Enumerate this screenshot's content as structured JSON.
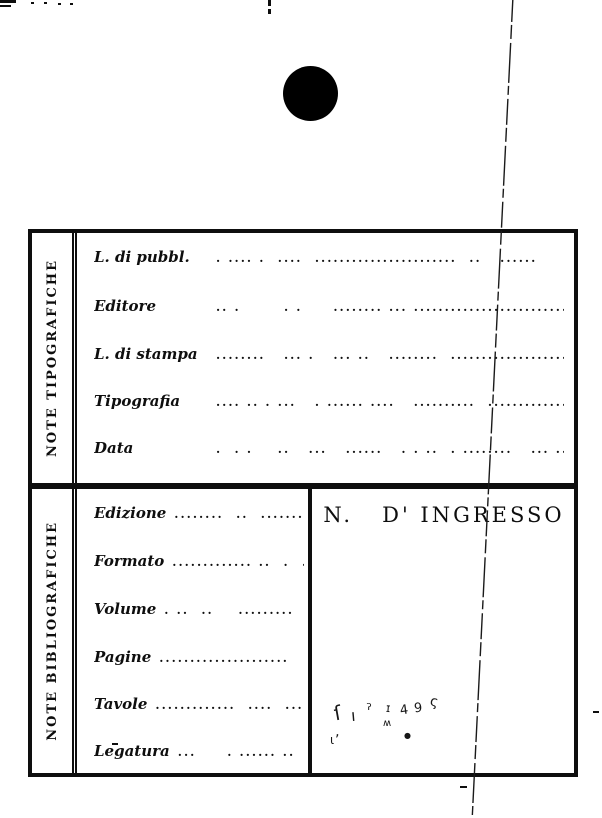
{
  "page": {
    "background": "#ffffff",
    "ink": "#0e0e0e"
  },
  "artifacts": {
    "punch_hole": {
      "x": 283,
      "y": 66,
      "diameter": 55
    },
    "diagonal_line": {
      "x1": 513,
      "y1": -4,
      "x2": 472,
      "y2": 822
    },
    "noise_rects": [
      {
        "x": 0,
        "y": 0,
        "w": 16,
        "h": 3
      },
      {
        "x": 0,
        "y": 5,
        "w": 11,
        "h": 2
      },
      {
        "x": 31,
        "y": 2,
        "w": 3,
        "h": 2
      },
      {
        "x": 44,
        "y": 2,
        "w": 3,
        "h": 2
      },
      {
        "x": 58,
        "y": 3,
        "w": 3,
        "h": 2
      },
      {
        "x": 70,
        "y": 3,
        "w": 3,
        "h": 2
      },
      {
        "x": 268,
        "y": 0,
        "w": 3,
        "h": 6
      },
      {
        "x": 268,
        "y": 9,
        "w": 3,
        "h": 5
      },
      {
        "x": 460,
        "y": 786,
        "w": 7,
        "h": 2
      },
      {
        "x": 593,
        "y": 711,
        "w": 6,
        "h": 2
      },
      {
        "x": 112,
        "y": 743,
        "w": 6,
        "h": 2
      }
    ]
  },
  "card": {
    "top": {
      "side_label": "NOTE TIPOGRAFICHE",
      "rows": [
        {
          "label": "L. di pubbl.",
          "dots": ". .... .  ....  .......................  ..   ......"
        },
        {
          "label": "Editore",
          "dots": ".. .       . .     ........ ... ..........................."
        },
        {
          "label": "L. di stampa",
          "dots": "........   ... .   ... ..   ........  ..................."
        },
        {
          "label": "Tipografia",
          "dots": ".... .. . ...   . ...... ....   ..........  ..............."
        },
        {
          "label": "Data",
          "dots": ".  . .    ..   ...   ......   . . ..  . ........   ... .. ."
        }
      ]
    },
    "bottom": {
      "side_label": "NOTE BIBLIOGRAFICHE",
      "rows": [
        {
          "label": "Edizione",
          "dots": "........  ..  ......."
        },
        {
          "label": "Formato",
          "dots": "............. ..  .  ."
        },
        {
          "label": "Volume",
          "dots": ". ..  ..    ........."
        },
        {
          "label": "Pagine",
          "dots": "....................."
        },
        {
          "label": "Tavole",
          "dots": ".............  ....  ..."
        },
        {
          "label": "Legatura",
          "dots": "...     . ...... .."
        }
      ],
      "ingresso_title": "N.   D' INGRESSO"
    }
  },
  "handwriting": {
    "description": "faint illegible pencil accession number",
    "marks": [
      {
        "ch": "ſ",
        "x": 334,
        "y": 701,
        "s": 20,
        "r": -10
      },
      {
        "ch": "‚",
        "x": 335,
        "y": 724,
        "s": 14,
        "r": 0
      },
      {
        "ch": "ı",
        "x": 351,
        "y": 706,
        "s": 16,
        "r": -5
      },
      {
        "ch": "ˀ",
        "x": 366,
        "y": 700,
        "s": 16,
        "r": 0
      },
      {
        "ch": "ɪ",
        "x": 386,
        "y": 701,
        "s": 12,
        "r": 5
      },
      {
        "ch": "ʍ",
        "x": 383,
        "y": 718,
        "s": 10,
        "r": 0
      },
      {
        "ch": "4",
        "x": 400,
        "y": 703,
        "s": 13,
        "r": -8
      },
      {
        "ch": "9",
        "x": 414,
        "y": 701,
        "s": 13,
        "r": -5
      },
      {
        "ch": "ς",
        "x": 430,
        "y": 694,
        "s": 14,
        "r": 10
      },
      {
        "ch": "●",
        "x": 404,
        "y": 731,
        "s": 8,
        "r": 0
      },
      {
        "ch": "ɩ",
        "x": 330,
        "y": 733,
        "s": 12,
        "r": 0
      }
    ]
  }
}
